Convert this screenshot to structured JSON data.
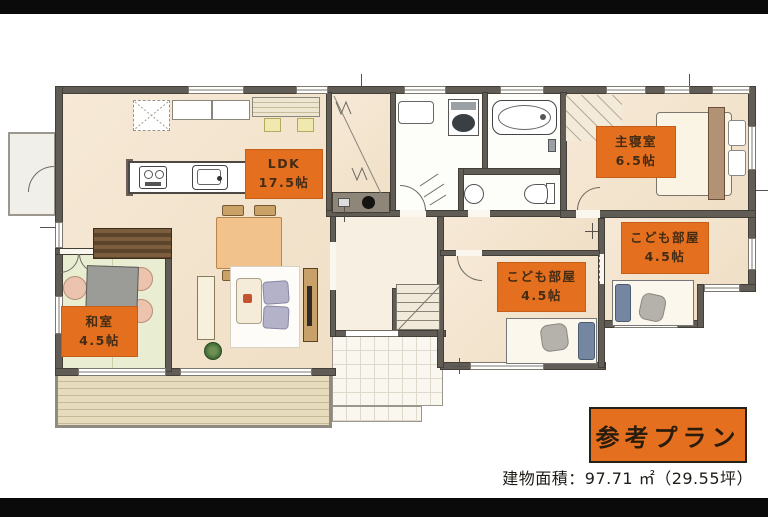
{
  "plan": {
    "room_labels": [
      {
        "id": "ldk",
        "line1": "LDK",
        "line2": "17.5帖"
      },
      {
        "id": "master",
        "line1": "主寝室",
        "line2": "6.5帖"
      },
      {
        "id": "kids-right",
        "line1": "こども部屋",
        "line2": "4.5帖"
      },
      {
        "id": "kids-left",
        "line1": "こども部屋",
        "line2": "4.5帖"
      },
      {
        "id": "washitsu",
        "line1": "和室",
        "line2": "4.5帖"
      }
    ],
    "title_box": "参考プラン",
    "area_note": "建物面積：97.71 ㎡（29.55坪）",
    "colors": {
      "label_bg": "#e4701f",
      "label_text": "#432b14",
      "title_border": "#25201a",
      "wall": "#615c55",
      "floor_wood": "#f5e7d3",
      "tatami": "#e8edd0",
      "deck_wood": "#e0d3b6"
    }
  }
}
